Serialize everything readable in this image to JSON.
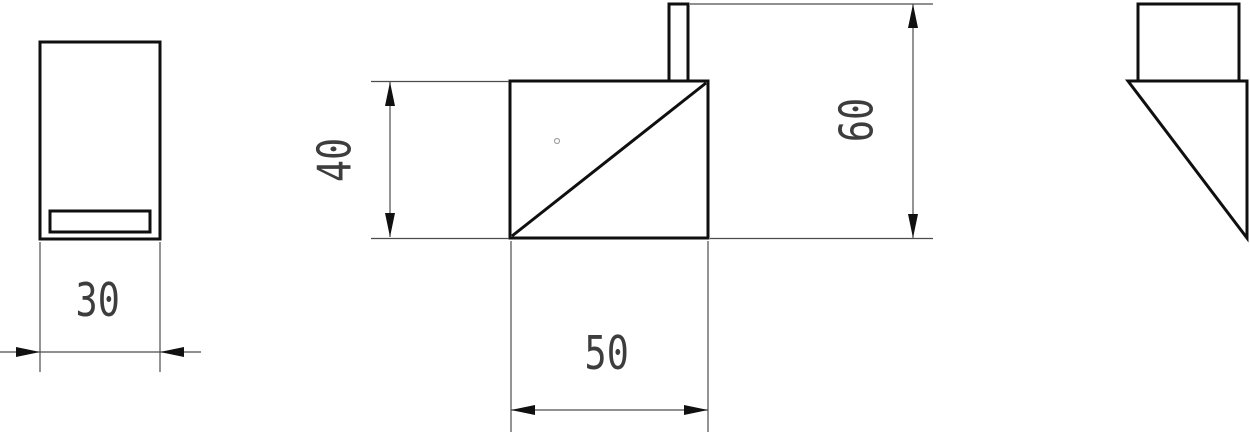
{
  "drawing": {
    "type": "orthographic-projection-technical-drawing",
    "background": "#ffffff",
    "outline_color": "#0f0f0f",
    "dimension_line_color": "#4d4d4d",
    "text_color": "#3d3d3d",
    "dimensions": [
      {
        "id": "left-view-width",
        "value": "30",
        "orientation": "horizontal"
      },
      {
        "id": "front-view-height",
        "value": "40",
        "orientation": "vertical"
      },
      {
        "id": "front-view-width",
        "value": "50",
        "orientation": "horizontal"
      },
      {
        "id": "overall-height",
        "value": "60",
        "orientation": "vertical"
      }
    ]
  }
}
